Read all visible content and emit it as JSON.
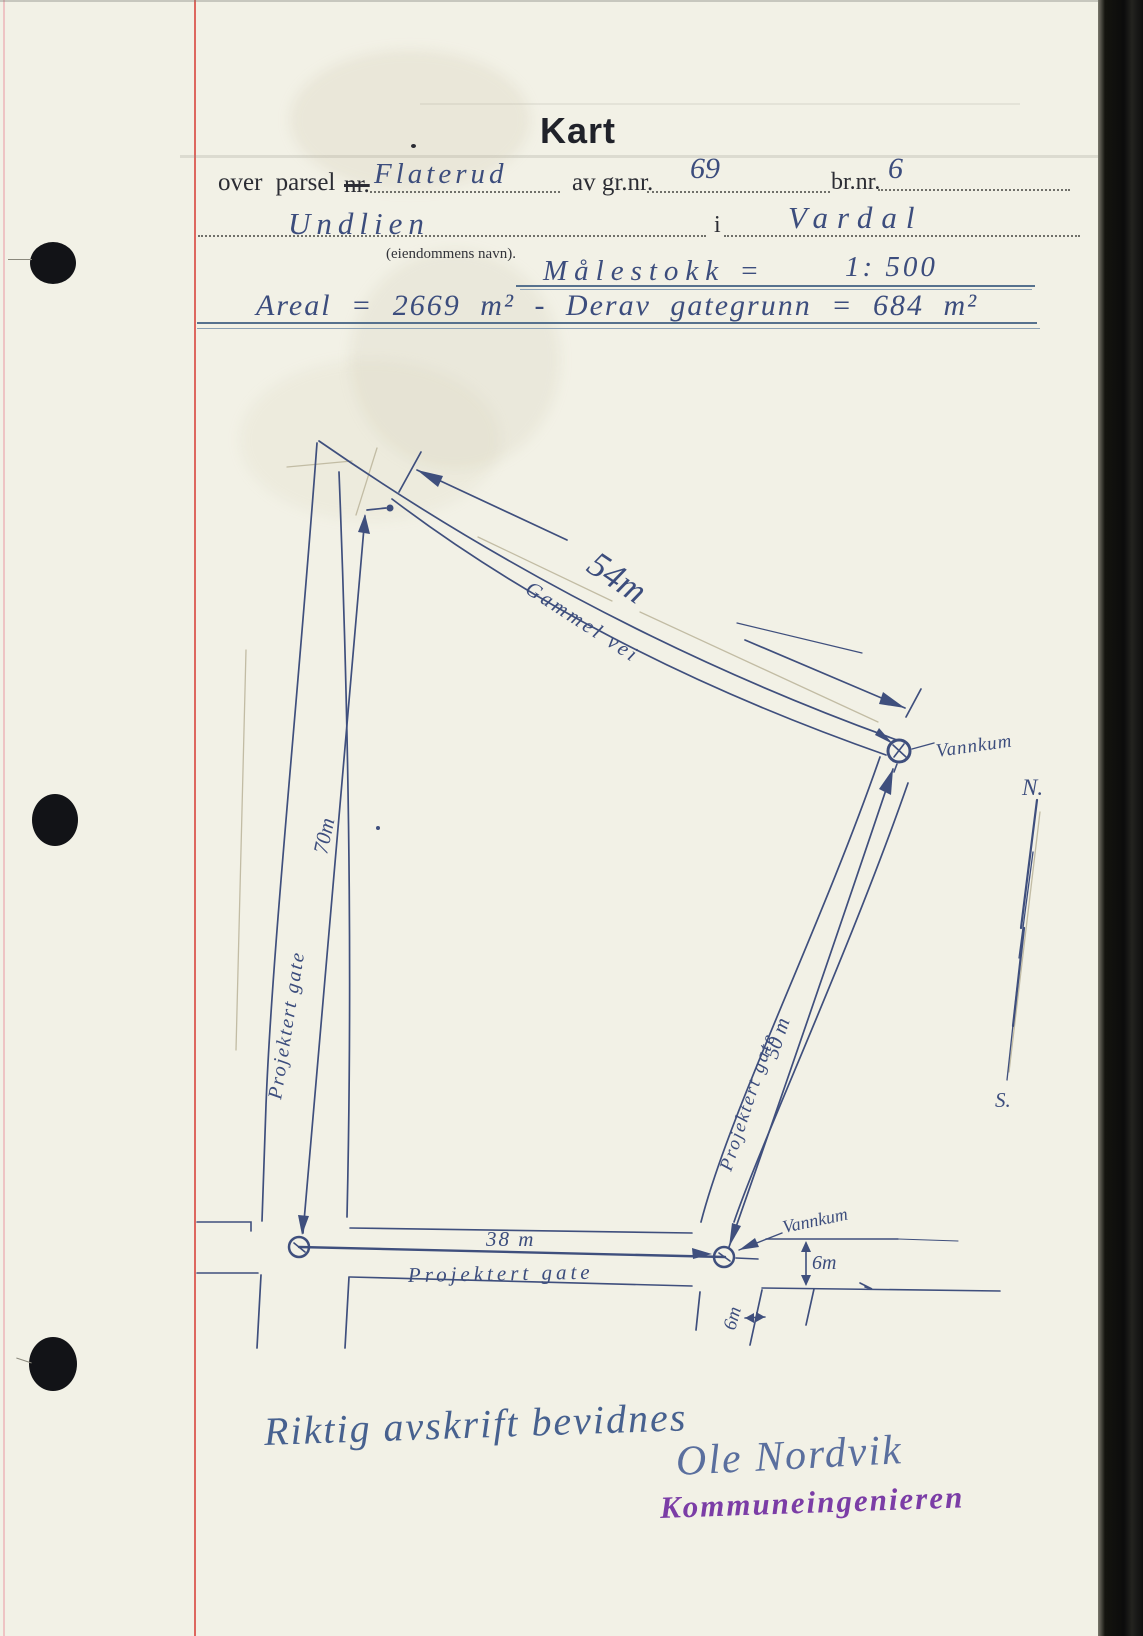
{
  "document": {
    "title": "Kart",
    "form": {
      "line1_prefix": "over parsel",
      "line1_struck": "nr.",
      "parcel_name": "Flaterud",
      "gnr_label": "av gr.nr.",
      "gnr_value": "69",
      "bnr_label": "br.nr.",
      "bnr_value": "6",
      "property_name": "Undlien",
      "property_caption": "(eiendommens navn).",
      "in_label": "i",
      "municipality": "Vardal",
      "scale_label": "Målestokk =",
      "scale_value": "1: 500",
      "area_line": "Areal = 2669 m² - Derav gategrunn = 684 m²"
    },
    "map": {
      "old_road_dim": "54m",
      "old_road_name": "Gammel vei",
      "west_street_name": "Projektert gate",
      "west_street_dim": "70m",
      "east_street_name": "Projektert gate",
      "east_street_dim": "50 m",
      "south_street_dim": "38 m",
      "south_street_name": "Projektert gate",
      "south_street_width": "6m",
      "east_street_width": "6m",
      "manhole_top_label": "Vannkum",
      "manhole_bottom_label": "Vannkum",
      "north_label": "N.",
      "south_label": "S."
    },
    "signature": {
      "attestation": "Riktig avskrift bevidnes",
      "name": "Ole Nordvik",
      "role_stamp": "Kommuneingenieren"
    },
    "colors": {
      "paper": "#f2f1e6",
      "ink": "#3c4d7d",
      "margin_red": "#d94f46",
      "stamp_purple": "#7b3da6"
    }
  }
}
